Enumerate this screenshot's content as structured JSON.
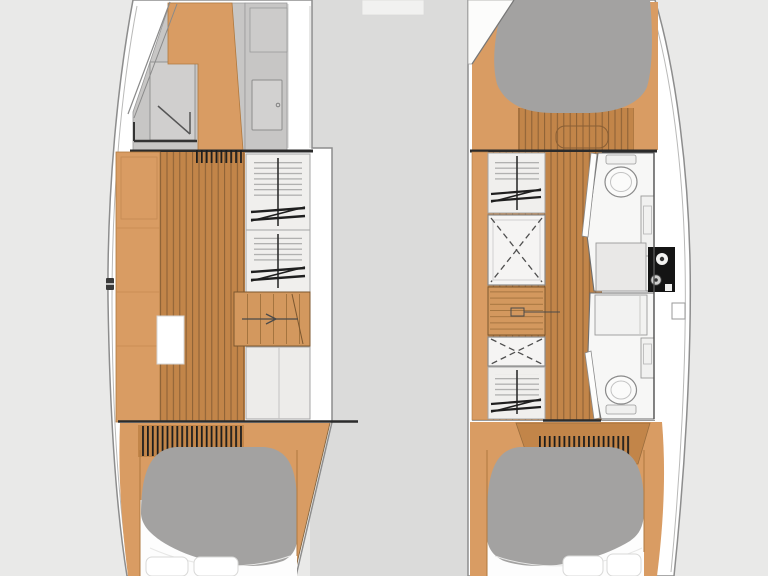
{
  "image": {
    "width": 768,
    "height": 576,
    "kind": "catamaran-interior-floorplan",
    "text_visible": false
  },
  "palette": {
    "bg": "#e9e9e8",
    "deck": "#dbdbda",
    "hull_white": "#ffffff",
    "hull_stroke": "#8d8d8d",
    "wall_gray": "#c7c6c5",
    "shower_gray": "#d0cfce",
    "wood": "#d99c63",
    "wood_edge": "#b0793f",
    "plank": "#c28549",
    "plank_line": "#8a5f35",
    "stair_wood": "#d3985e",
    "furniture_white": "#f0efed",
    "furniture_stroke": "#a5a5a5",
    "hatch_white": "#f5f4f3",
    "bed_gray": "#a3a2a1",
    "sheet_white": "#fdfdfd",
    "bulkhead_ink": "#2b2b2b",
    "appliance_black": "#141414"
  },
  "regions": {
    "bridge_deck": {
      "type": "deck"
    },
    "port_hull": {
      "forward": [
        "shower-pan",
        "wood-platform",
        "cabinet",
        "door"
      ],
      "midship": [
        "side-berth",
        "plank-floor",
        "floor-hatch",
        "wardrobe",
        "wardrobe",
        "staircase-with-arrow",
        "counter"
      ],
      "aft": [
        "plank-floor",
        "double-berth-duvet",
        "sheet",
        "pillow",
        "pillow"
      ]
    },
    "starboard_hull": {
      "forward": [
        "double-berth",
        "plank-floor-foot"
      ],
      "midship": [
        "wardrobe",
        "hatch-dashed-x",
        "staircase-with-arrow",
        "hatch-dashed-x",
        "wardrobe",
        "forward-head",
        "toilet",
        "vanity",
        "counter",
        "appliance-panel",
        "aft-head",
        "toilet",
        "vanity",
        "boarding-notch"
      ],
      "aft": [
        "plank-floor",
        "double-berth-duvet",
        "sheet",
        "pillow",
        "pillow"
      ]
    }
  }
}
